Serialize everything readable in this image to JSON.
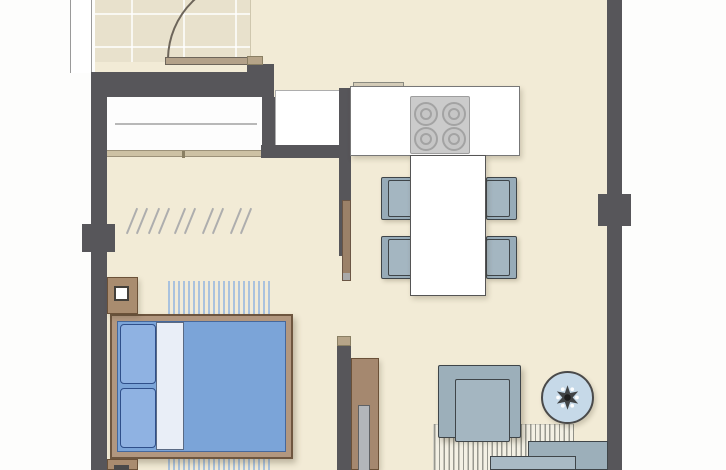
{
  "document": {
    "type": "architectural-floor-plan",
    "view": "top-down apartment plan",
    "visible_text": [],
    "palette": {
      "outside": "#fdfdfc",
      "floor_main": "#f2ebd6",
      "floor_tile": "#e8e1cc",
      "wall": "#57565a",
      "wood_frame": "#b2977f",
      "wood_cabinet": "#a5886f",
      "tan_trim": "#cdc1a4",
      "bed_blue": "#7ba4d8",
      "pillow_blue": "#8fb2e2",
      "sheet_white": "#e9eef7",
      "seat_gray_blue": "#9cafba",
      "rug_blue_stripe": "#a9c2de",
      "rug_gray_stripe": "#98988f",
      "round_table_blue": "#c6d9e8",
      "cooktop_gray": "#cbcbcb",
      "counter_white": "#ffffff"
    }
  },
  "rooms": [
    {
      "id": "bathroom",
      "position": "top-left",
      "features": [
        "tiled-floor",
        "swing-door-arc",
        "window-strip"
      ]
    },
    {
      "id": "wardrobe",
      "position": "left-upper",
      "features": [
        "clothes-rail",
        "hangers",
        "sliding-door-track"
      ],
      "hanger_slash_count": 10
    },
    {
      "id": "bedroom",
      "position": "left-lower",
      "furniture": [
        "double-bed",
        "nightstand-top",
        "nightstand-bottom",
        "blue-striped-rug"
      ]
    },
    {
      "id": "kitchen-dining",
      "position": "top-right",
      "furniture": [
        "kitchen-counter",
        "cooktop-4-burners",
        "appliance-alcove",
        "dining-table",
        "four-chairs"
      ]
    },
    {
      "id": "living",
      "position": "bottom-right",
      "furniture": [
        "armchair",
        "sofa",
        "round-side-table",
        "tv-sideboard",
        "gray-striped-rug"
      ]
    }
  ],
  "furniture": [
    {
      "name": "double-bed",
      "color": "#7ba4d8",
      "details": [
        "two-pillows",
        "white-sheet-band",
        "wood-frame"
      ]
    },
    {
      "name": "dining-table",
      "color": "#ffffff",
      "chairs": 4,
      "chair_color": "#97abb8"
    },
    {
      "name": "cooktop",
      "burners": 4,
      "color": "#cbcbcb"
    },
    {
      "name": "armchair",
      "color": "#9cafba"
    },
    {
      "name": "sofa",
      "color": "#9cafba"
    },
    {
      "name": "round-side-table",
      "color": "#c6d9e8",
      "ornament": "dark-star-with-white-dots"
    },
    {
      "name": "tv-sideboard",
      "color": "#a5886f"
    },
    {
      "name": "wardrobe-hangers",
      "count": 5
    }
  ],
  "walls": {
    "piers": [
      "left-pier",
      "right-pier"
    ],
    "doors": [
      "bathroom-swing-door",
      "bedroom-pocket-door",
      "wardrobe-sliding-door"
    ]
  }
}
